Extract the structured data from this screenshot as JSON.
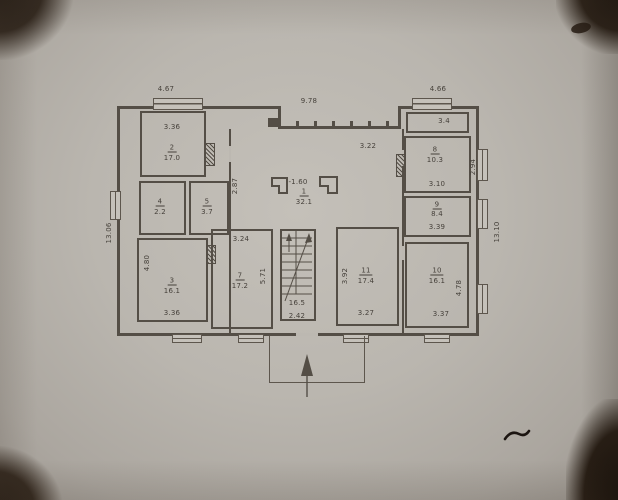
{
  "colors": {
    "paper": "#bab6af",
    "ink": "#544e46",
    "text": "#46413b"
  },
  "overall_dimensions": {
    "top_left": "4.67",
    "top_center": "9.78",
    "top_right": "4.66",
    "left_side": "13.06",
    "right_side": "13.10"
  },
  "rooms": {
    "hall": {
      "number": "1",
      "area": "32.1",
      "level_mark": "-1.60",
      "dim_left": "2.87",
      "dim_top": "3.22"
    },
    "room2": {
      "number": "2",
      "area": "17.0",
      "dim_top": "3.36"
    },
    "room3": {
      "number": "3",
      "area": "16.1",
      "dim_bottom": "3.36",
      "dim_left": "4.80"
    },
    "room4": {
      "number": "4",
      "area": "2.2"
    },
    "room5": {
      "number": "5",
      "area": "3.7"
    },
    "room7": {
      "number": "7",
      "area": "17.2",
      "dim_top": "3.24",
      "dim_right": "5.71"
    },
    "room8": {
      "number": "8",
      "area": "10.3",
      "dim_bottom": "3.10",
      "dim_right": "2.94"
    },
    "room9": {
      "number": "9",
      "area": "8.4",
      "dim_bottom": "3.39"
    },
    "room10": {
      "number": "10",
      "area": "16.1",
      "dim_bottom": "3.37",
      "dim_right": "4.78"
    },
    "room11": {
      "number": "11",
      "area": "17.4",
      "dim_bottom": "3.27",
      "dim_left": "3.92"
    },
    "room_top_right": {
      "area": "3.4"
    },
    "stairwell": {
      "area": "16.5",
      "dim_bottom": "2.42"
    }
  }
}
